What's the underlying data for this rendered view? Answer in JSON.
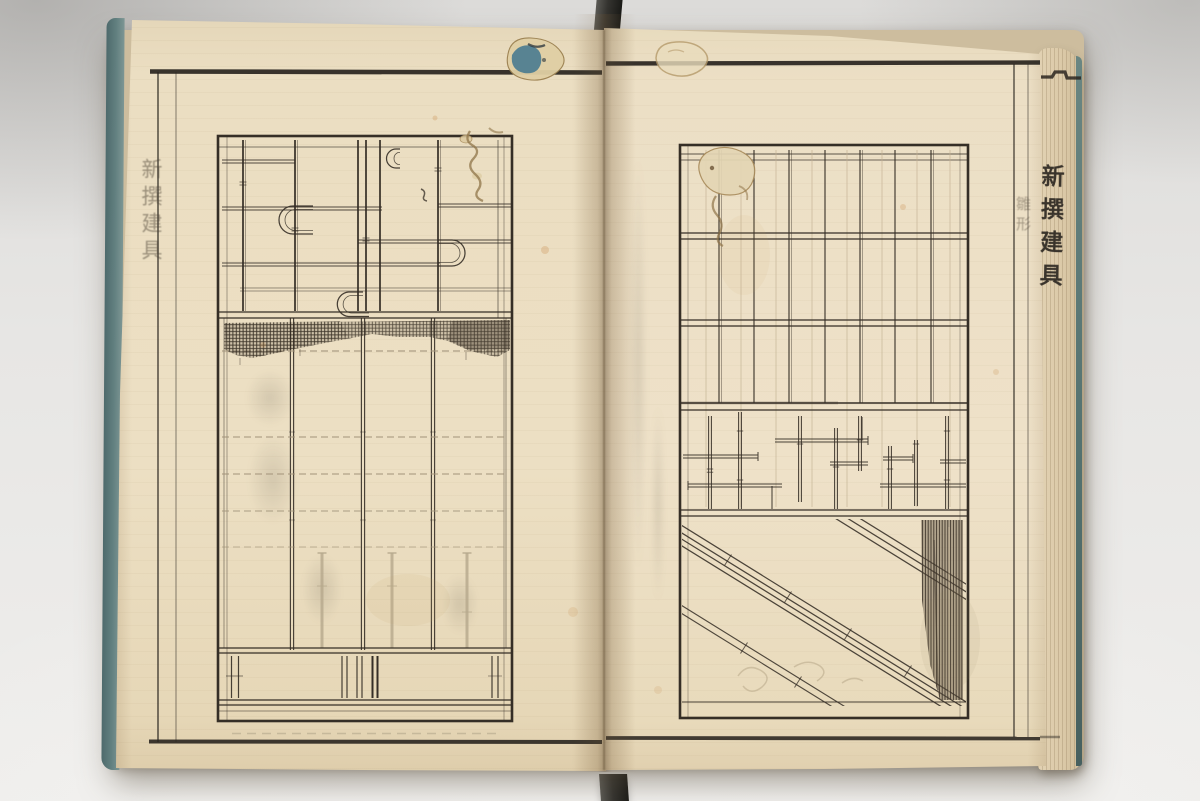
{
  "book": {
    "left_page": {
      "margin_title": "新撰建具"
    },
    "fore_edge": {
      "spine_title": "新撰建具",
      "spine_title_faint": "雛形"
    }
  },
  "palette": {
    "photo_background": "#e7e6e4",
    "paper": "#ebdec2",
    "paper_shadow": "#d9c7a5",
    "ink": "#352e26",
    "ink_faint": "#a2947a",
    "ghost_lines": "#b5a88c",
    "cover_teal": "#5d7a7c",
    "strap": "#34332f",
    "stain_blue": "#44798f",
    "stain_brown": "#9b7f52",
    "worm_crust": "#ddcba3"
  }
}
